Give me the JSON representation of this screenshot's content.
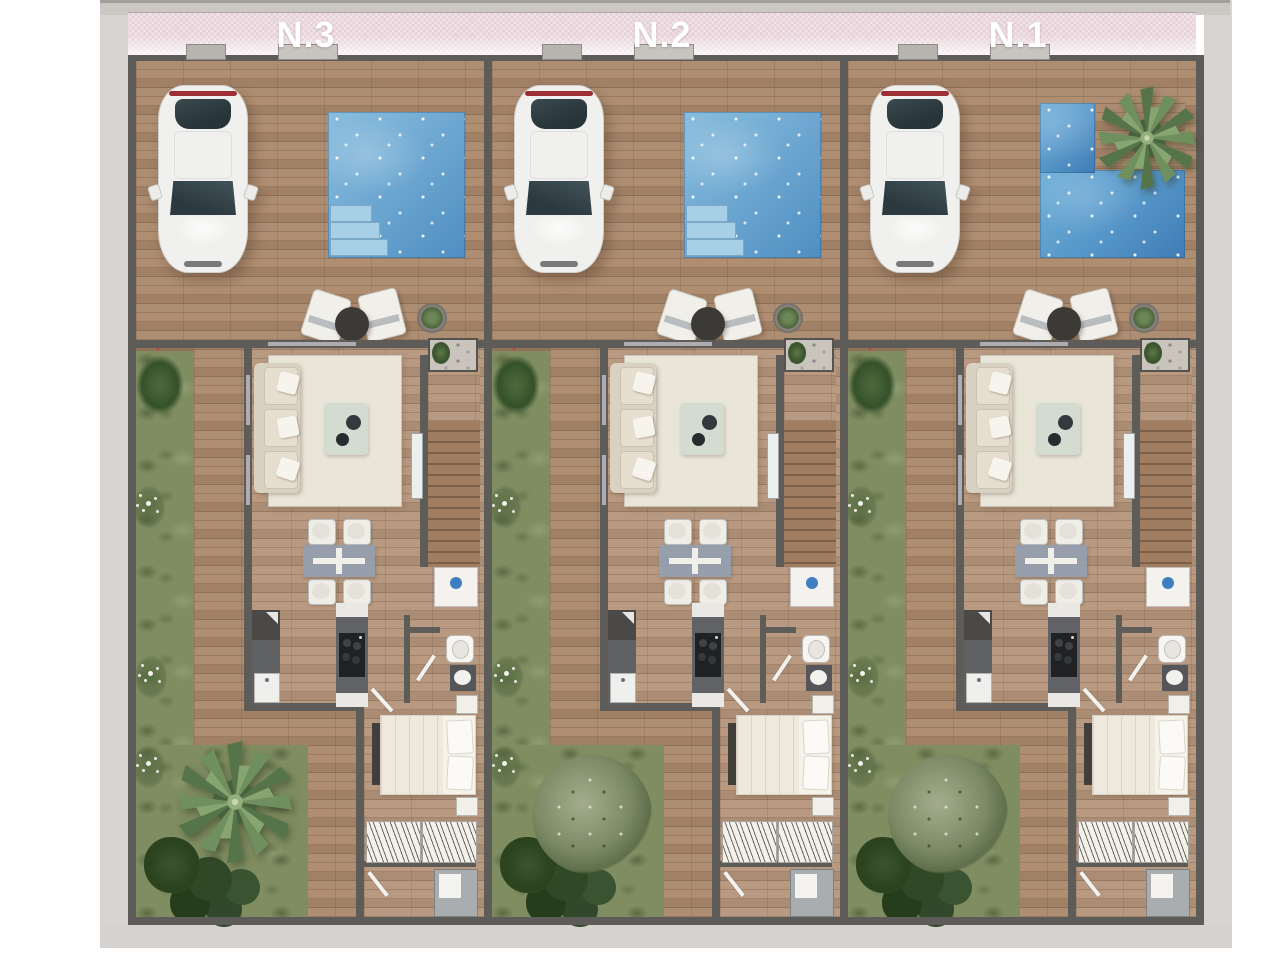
{
  "page": {
    "type": "architectural-site-plan-render",
    "description_text": "",
    "background_color": "#ffffff"
  },
  "plan": {
    "units": [
      {
        "label": "N.3",
        "pool_shape": "rectangular",
        "pool_palm": false,
        "garden_feature": "palm"
      },
      {
        "label": "N.2",
        "pool_shape": "rectangular",
        "pool_palm": false,
        "garden_feature": "olive-tree"
      },
      {
        "label": "N.1",
        "pool_shape": "l-shaped",
        "pool_palm": true,
        "garden_feature": "olive-tree"
      }
    ],
    "objects_per_unit": [
      "parked-car",
      "swimming-pool",
      "pool-steps",
      "lounge-chairs",
      "side-table",
      "potted-plant",
      "entry-planter",
      "sofa",
      "rug",
      "coffee-table",
      "staircase",
      "glass-rail",
      "dining-table",
      "dining-chairs",
      "refrigerator",
      "kitchen-counter",
      "kitchen-island",
      "cooktop",
      "sink",
      "toilet",
      "washbasin",
      "double-bed",
      "nightstands",
      "wardrobe",
      "shower",
      "doors",
      "garden-strip",
      "flower-bushes",
      "dark-foliage"
    ],
    "colors": {
      "street_band": "#e6d1d7",
      "label_text": "#ffffff",
      "walls": "#5e5c58",
      "terrace_wood": "#aa886b",
      "interior_wood": "#b4947a",
      "pool_water": "#6fa9d2",
      "pool_water_dark": "#3f7cb5",
      "pool_steps": "#a7d0e6",
      "grass": "#7f8d61",
      "dark_foliage": "#2c431f",
      "sidewalk": "#d8d4d1",
      "car_body": "#f0f0ee",
      "car_taillight": "#9c3036",
      "sofa": "#d9d1c1",
      "dining_table": "#949eb0",
      "kitchen_counter": "#606265",
      "cooktop": "#1f2123",
      "fridge_logo": "#3f7fc1",
      "bed_linen": "#f5f2ea"
    }
  }
}
